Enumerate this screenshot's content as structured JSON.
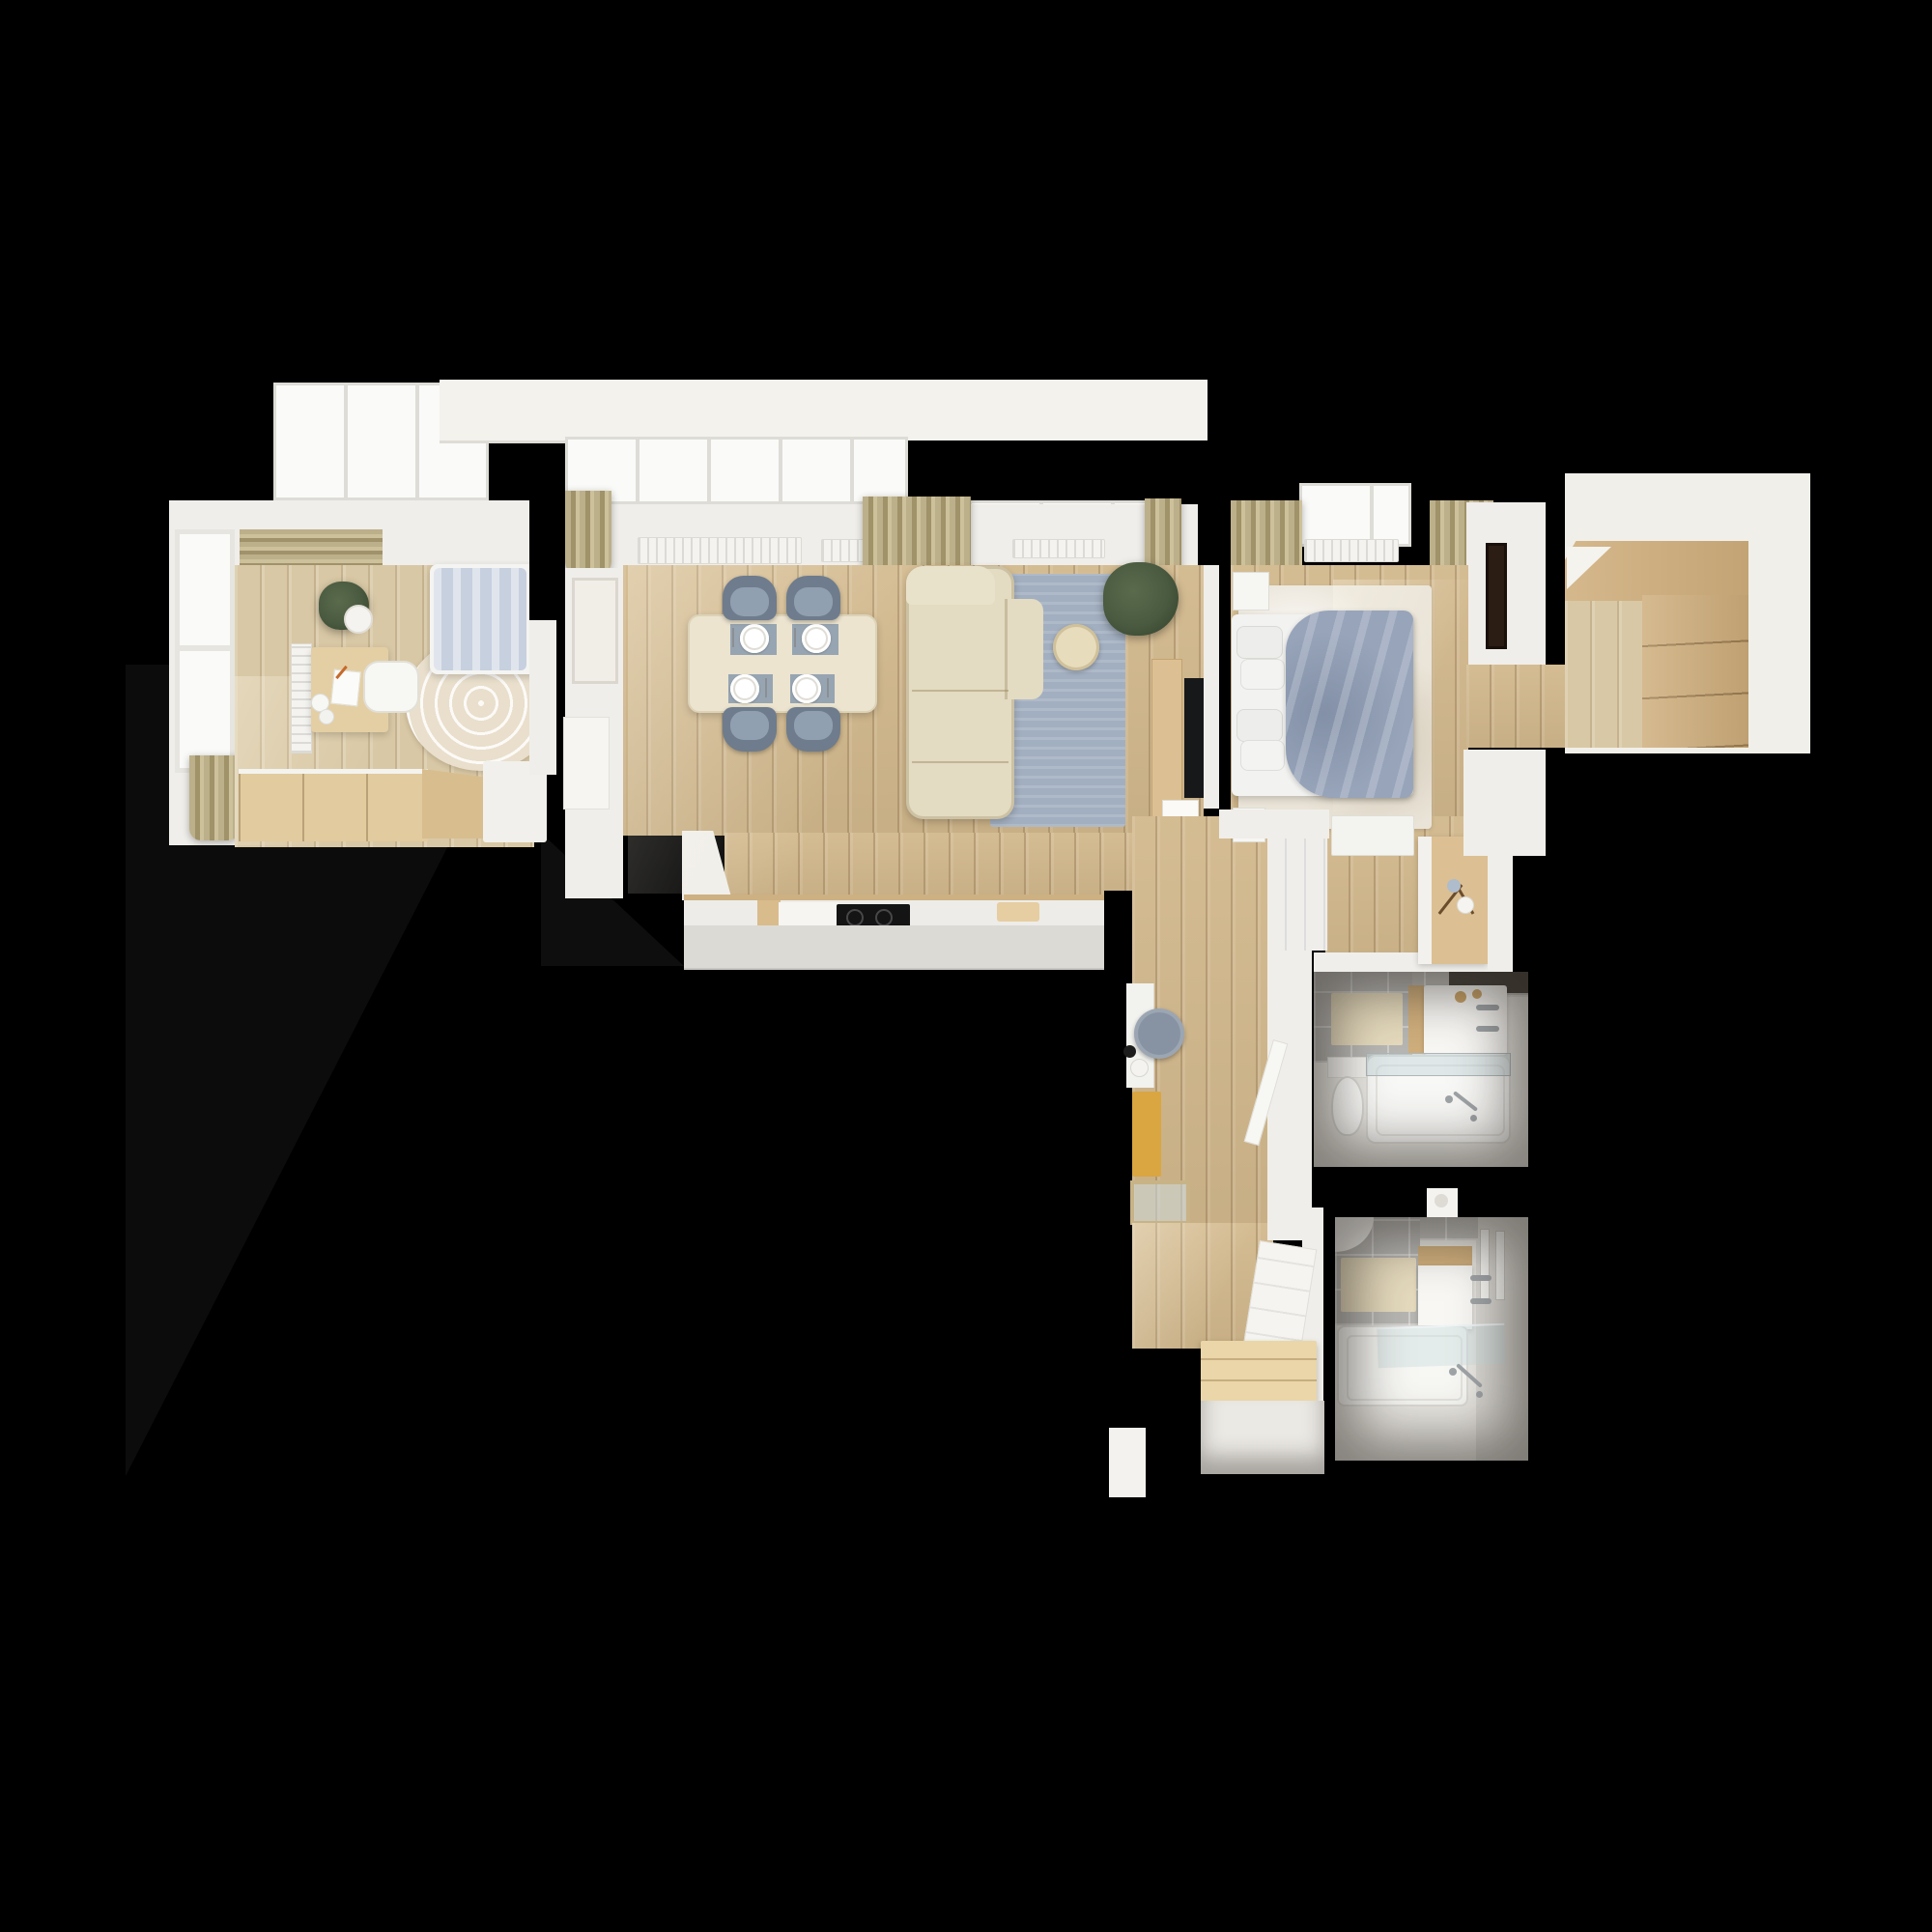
{
  "scene": {
    "description": "Top-down 3D rendered floor plan of an apartment on a black background",
    "background": "#000000"
  },
  "palette": {
    "bg": "#000000",
    "wall": "#f0eeea",
    "glass": "#fafaf8",
    "glassFrame": "#dddcd6",
    "wood": "#d2b88c",
    "woodLight": "#d9c8a5",
    "wardrobeWood": "#cfae7c",
    "cabinetWood": "#dcc093",
    "curtain": "#b3a67e",
    "sofa": "#e3dbc2",
    "rugBlue": "#a2afc0",
    "pouf": "#e7dcbc",
    "chairBack": "#6e7c8d",
    "chairSeat": "#91a0b0",
    "table": "#ece4cf",
    "placemat": "#97a5b2",
    "duvetDouble": "#97a4ba",
    "duvetSingle": "#c7d0df",
    "rugWashed": "#eae4d8",
    "rugRound": "#e9dfcc",
    "rugMustard": "#d9a642",
    "stool": "#8793a3",
    "counter": "#edece8",
    "counterFace": "#dcdad5",
    "cooktop": "#141414",
    "tile": "#bfbeba",
    "matBeige": "#e5dabd",
    "fixture": "#f8f7f4",
    "chrome": "#9fa4a7",
    "plant": "#4a5a40",
    "plantDark": "#36452f",
    "tv": "#17181a",
    "frameDark": "#2b1d14",
    "bench": "#ead6a8",
    "gold": "#c9a368"
  },
  "rooms": [
    {
      "id": "bedroom-left",
      "label": "Bedroom 1",
      "items": [
        "single bed",
        "striped duvet",
        "round patterned rug",
        "desk",
        "desk chair",
        "desk lamp",
        "potted plant",
        "wardrobe",
        "window",
        "curtains",
        "radiator"
      ]
    },
    {
      "id": "living-dining",
      "label": "Living / Dining Room",
      "items": [
        "dining table",
        "4 gray chairs",
        "4 place settings",
        "corner sofa",
        "blue area rug",
        "round pouf",
        "potted plant",
        "TV sideboard",
        "TV",
        "book decor",
        "windows",
        "curtains",
        "radiators",
        "wall art",
        "roller blind"
      ]
    },
    {
      "id": "kitchen",
      "label": "Kitchen",
      "items": [
        "island counter",
        "induction cooktop",
        "cutting board"
      ]
    },
    {
      "id": "hallway",
      "label": "Hallway",
      "items": [
        "console desk",
        "round stool",
        "vases",
        "mustard runner rug",
        "framed floor mat",
        "wood bench",
        "leaning radiator panel",
        "doors"
      ]
    },
    {
      "id": "dressing-hall",
      "label": "Dressing Hall",
      "items": [
        "white desk",
        "cabinet with branch vase",
        "closet doors"
      ]
    },
    {
      "id": "bedroom-right",
      "label": "Bedroom 2",
      "items": [
        "double bed",
        "4 pillows",
        "blue-gray duvet",
        "2 nightstands",
        "washed area rug",
        "dark wall mirror",
        "window",
        "curtains",
        "radiator"
      ]
    },
    {
      "id": "entry-wardrobe",
      "label": "Entry / Wardrobe",
      "items": [
        "built-in wardrobe",
        "wood floor"
      ]
    },
    {
      "id": "bathroom-1",
      "label": "Bathroom 1",
      "items": [
        "toilet",
        "bathtub with glass screen",
        "vanity sink",
        "gold soap dishes",
        "bath mat",
        "shower fixture",
        "gray tiles"
      ]
    },
    {
      "id": "bathroom-2",
      "label": "Bathroom 2",
      "items": [
        "corner toilet",
        "bathtub",
        "glass screen",
        "vanity sink",
        "bath mat",
        "towel rails",
        "wall shelf",
        "gray tiles"
      ]
    }
  ]
}
